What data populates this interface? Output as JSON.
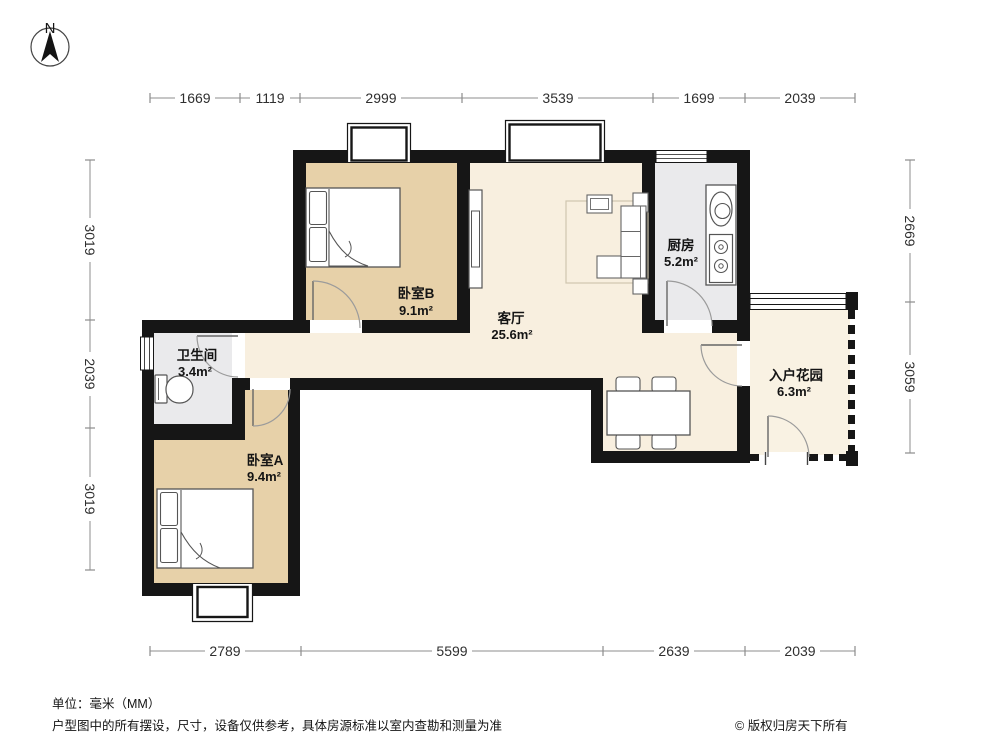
{
  "compass": {
    "label": "N"
  },
  "dimensions": {
    "top": [
      "1669",
      "1119",
      "2999",
      "3539",
      "1699",
      "2039"
    ],
    "bottom": [
      "2789",
      "5599",
      "2639",
      "2039"
    ],
    "left": [
      "3019",
      "2039",
      "3019"
    ],
    "right": [
      "2669",
      "3059"
    ]
  },
  "rooms": {
    "bedroomB": {
      "name": "卧室B",
      "area": "9.1m²"
    },
    "living": {
      "name": "客厅",
      "area": "25.6m²"
    },
    "kitchen": {
      "name": "厨房",
      "area": "5.2m²"
    },
    "bathroom": {
      "name": "卫生间",
      "area": "3.4m²"
    },
    "bedroomA": {
      "name": "卧室A",
      "area": "9.4m²"
    },
    "garden": {
      "name": "入户花园",
      "area": "6.3m²"
    }
  },
  "footer": {
    "unit_note": "单位：毫米（MM）",
    "disclaimer": "户型图中的所有摆设，尺寸，设备仅供参考，具体房源标准以室内查勘和测量为准",
    "copyright": "© 版权归房天下所有"
  },
  "colors": {
    "wall": "#161616",
    "bedroom_fill": "#e7d1a9",
    "living_fill": "#f8efdf",
    "garden_fill": "#f9f2e3",
    "utility_fill": "#eaeaec",
    "dimension_line": "#8c8c8c"
  }
}
